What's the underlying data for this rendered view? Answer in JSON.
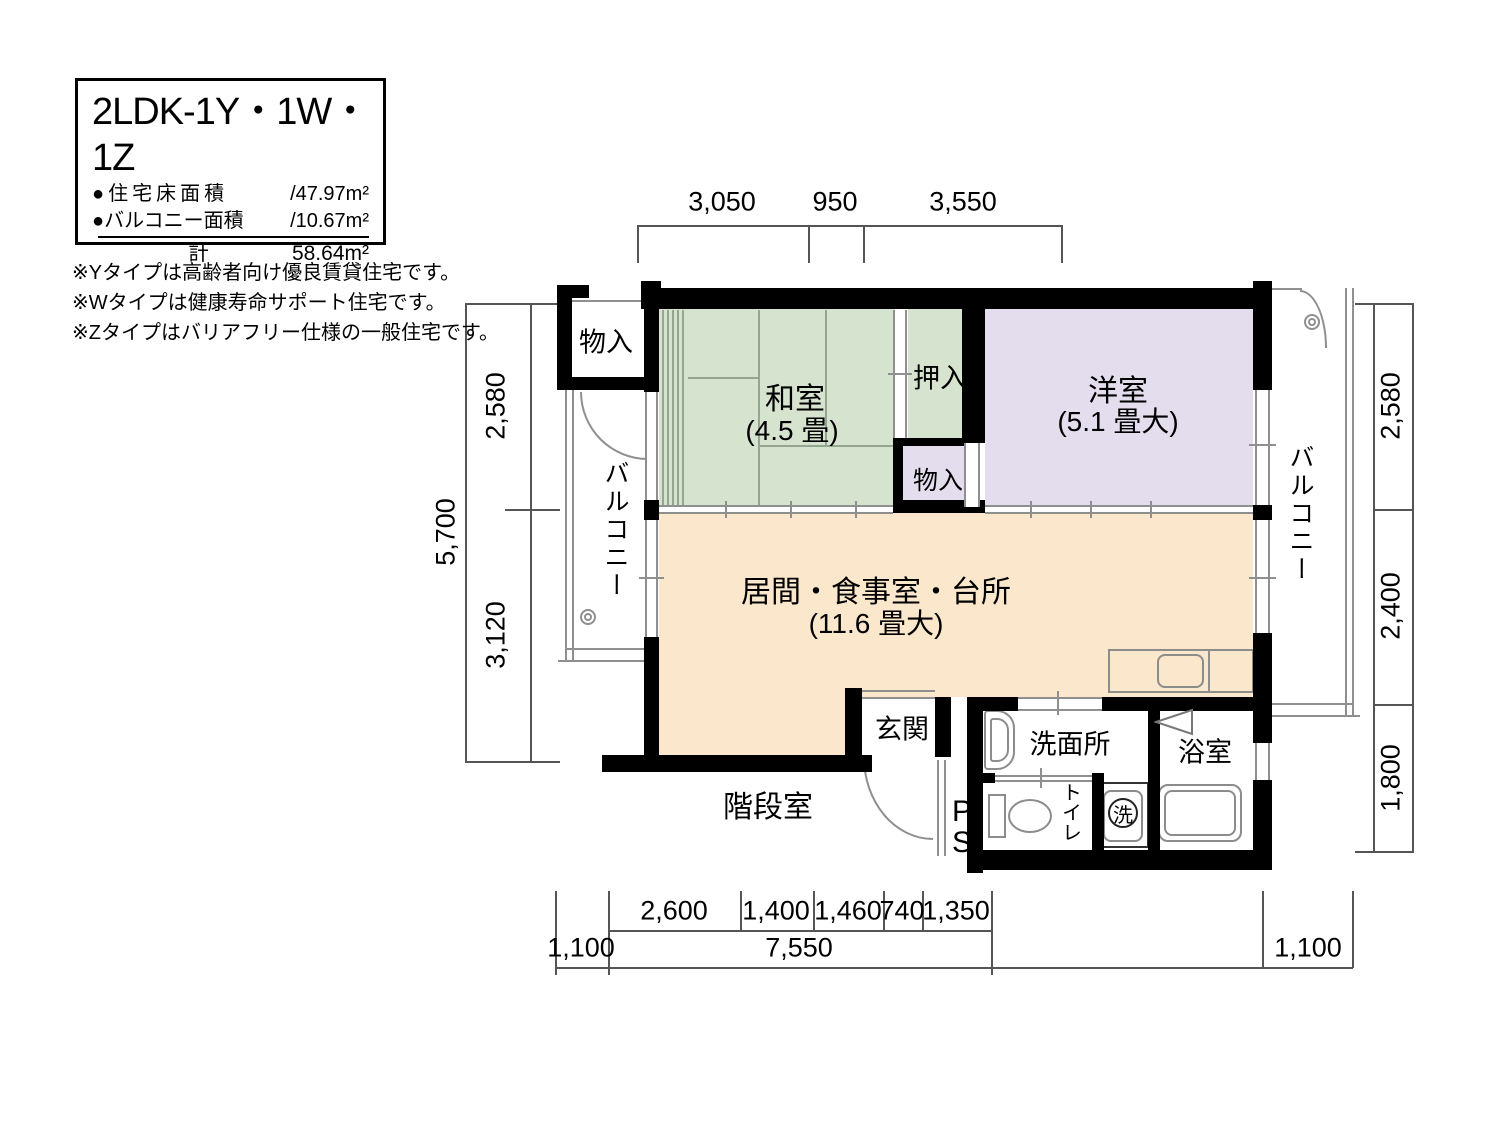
{
  "legend": {
    "title": "2LDK-1Y・1W・1Z",
    "rows": [
      {
        "label": "●住宅床面積",
        "value": "/47.97m²"
      },
      {
        "label": "●バルコニー面積",
        "value": "/10.67m²"
      }
    ],
    "total_label": "計",
    "total_value": "58.64m²"
  },
  "notes": [
    "※Yタイプは高齢者向け優良賃貸住宅です。",
    "※Wタイプは健康寿命サポート住宅です。",
    "※Zタイプはバリアフリー仕様の一般住宅です。"
  ],
  "rooms": {
    "washitsu": {
      "name": "和室",
      "size": "(4.5 畳)"
    },
    "youshitsu": {
      "name": "洋室",
      "size": "(5.1 畳大)"
    },
    "ldk": {
      "name": "居間・食事室・台所",
      "size": "(11.6 畳大)"
    },
    "oshiire": "押入",
    "monoire_top": "物入",
    "monoire_mid": "物入",
    "genkan": "玄関",
    "senmenjo": "洗面所",
    "yokushitsu": "浴室",
    "toilet": "トイレ",
    "laundry": "洗",
    "ps": "PS",
    "stairs": "階段室",
    "balcony_left": "バルコニー",
    "balcony_right": "バルコニー"
  },
  "dimensions": {
    "top": [
      "3,050",
      "950",
      "3,550"
    ],
    "left_segments": [
      "2,580",
      "3,120"
    ],
    "left_total": "5,700",
    "right_segments": [
      "2,580",
      "2,400",
      "1,800"
    ],
    "bottom_segments": [
      "2,600",
      "1,400",
      "1,460",
      "740",
      "1,350"
    ],
    "bottom_total": "7,550",
    "bottom_left_balcony": "1,100",
    "bottom_right_balcony": "1,100"
  },
  "colors": {
    "tatami": "#d6e4cf",
    "western": "#e4dded",
    "ldk": "#fbe7cb",
    "wall": "#000000"
  }
}
